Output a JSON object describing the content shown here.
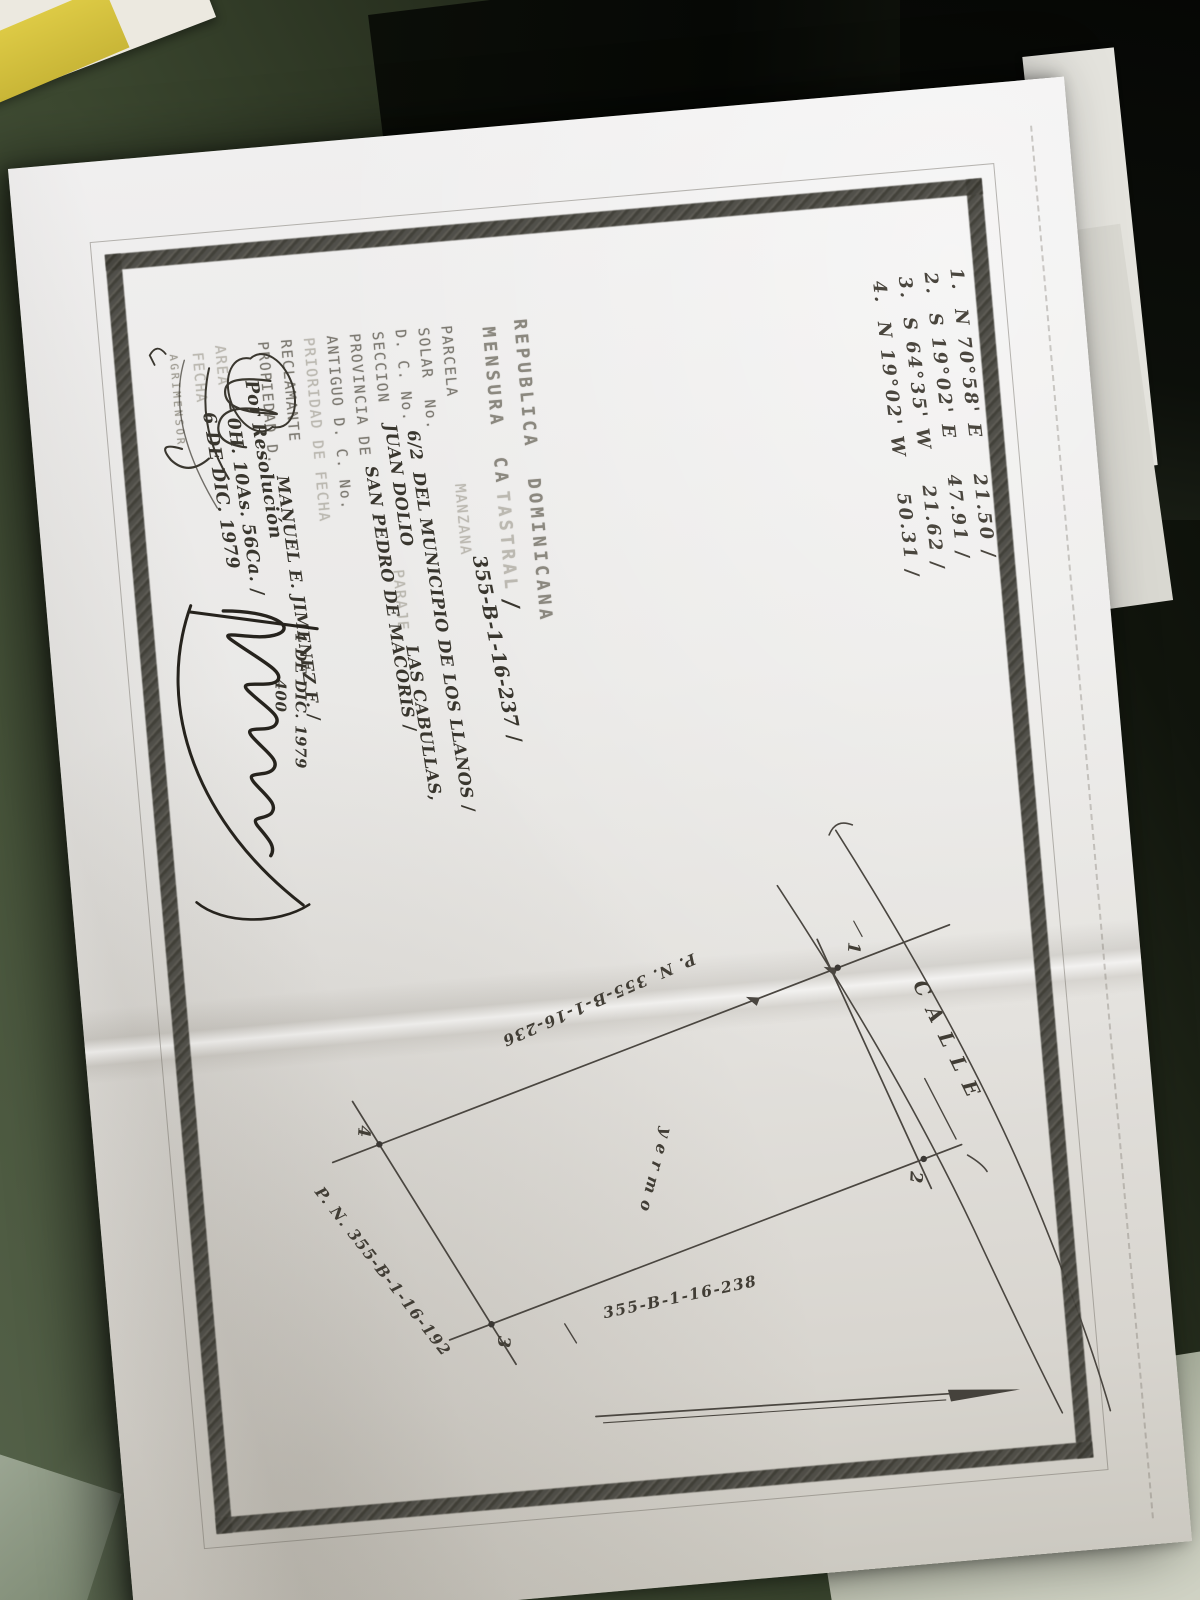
{
  "colors": {
    "desk_green": "#3f4a33",
    "paper": "#e9e8e4",
    "frame_band": "#454440",
    "ink": "#39362e",
    "typed_gray": "#7d7a72",
    "pad_yellow": "#d7c53e"
  },
  "doc": {
    "bearings": [
      "1.  N 70°58' E    21.50 ∕",
      "2.  S 19°02' E    47.91 ∕",
      "3.  S 64°35' W    21.62 ∕",
      "4.  N 19°02' W    50.31 ∕"
    ],
    "title1": "REPUBLICA  DOMINICANA",
    "title2a": "MENSURA  CA",
    "title2b": "TASTRAL",
    "title_check": "∕",
    "parcel_no": "355-B-1-16-237 ∕",
    "parcela_label": "PARCELA",
    "manzana_label": "MANZANA",
    "solar_label": "SOLAR  No.",
    "dc_label": "D. C. No.",
    "dc_no": "6/2",
    "dc_municipio": "DEL MUNICIPIO DE LOS LLANOS ∕",
    "seccion_label": "SECCION",
    "seccion_val": "JUAN DOLIO",
    "paraje_label": "PARAJE",
    "paraje_val": "LAS CABULLAS,",
    "provincia_label": "PROVINCIA DE",
    "provincia_val": "SAN PEDRO DE MACORIS ∕",
    "antiguo_label": "ANTIGUO D. C. No.",
    "prioridad_label": "PRIORIDAD DE FECHA",
    "reclamante_label": "RECLAMANTE",
    "propiedad_label": "PROPIEDAD D.",
    "propiedad_val": "MANUEL E. JIMENEZ F. ∕",
    "fecha_presentacion": "4 DE DIC. 1979",
    "numero": "400",
    "resolucion": "Por Resolución",
    "area_label": "AREA",
    "area_val": "– 0H. 10As. 56Ca. ∕",
    "fecha_label": "FECHA",
    "fecha_val": "6 DE DIC. 1979",
    "agrimensor_label": "AGRIMENSOR"
  },
  "plot": {
    "calle": "C A L L E",
    "yermo": "y e r m o",
    "corners": [
      "1",
      "2",
      "3",
      "4"
    ],
    "neighbor_nw": "P. N. 355-B-1-16-236",
    "neighbor_sw": "P. N. 355-B-1-16-192",
    "neighbor_se": "355-B-1-16-238"
  }
}
